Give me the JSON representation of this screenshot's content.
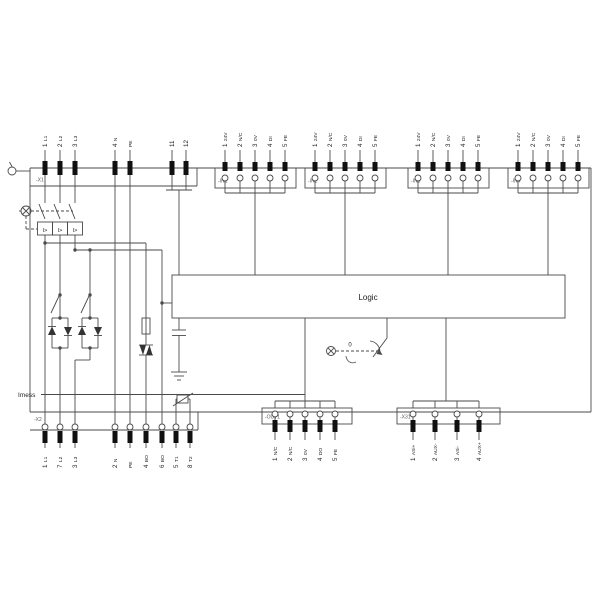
{
  "title": "wiring-schematic",
  "colors": {
    "line": "#4a4a4a",
    "text": "#1c1c1c",
    "muted": "#5a5a5a",
    "terminal": "#101010",
    "bg": "#ffffff"
  },
  "logic": {
    "label": "Logic"
  },
  "imess": {
    "label": "Imess"
  },
  "breaker": {
    "trip_label": "I>"
  },
  "manual_switch": {
    "zero_label": "0"
  },
  "top_connector": {
    "name": "-X1",
    "pins": [
      {
        "n": "1",
        "t": "L1"
      },
      {
        "n": "2",
        "t": "L2"
      },
      {
        "n": "3",
        "t": "L3"
      },
      {
        "n": "4",
        "t": "N"
      },
      {
        "n": "",
        "t": "PE"
      },
      {
        "n": "11",
        "t": ""
      },
      {
        "n": "12",
        "t": ""
      }
    ]
  },
  "input_connectors": [
    {
      "name": "-IN1",
      "pins": [
        {
          "n": "1",
          "t": "24V"
        },
        {
          "n": "2",
          "t": "N/C"
        },
        {
          "n": "3",
          "t": "0V"
        },
        {
          "n": "4",
          "t": "DI"
        },
        {
          "n": "5",
          "t": "FE"
        }
      ]
    },
    {
      "name": "-IN2",
      "pins": [
        {
          "n": "1",
          "t": "24V"
        },
        {
          "n": "2",
          "t": "N/C"
        },
        {
          "n": "3",
          "t": "0V"
        },
        {
          "n": "4",
          "t": "DI"
        },
        {
          "n": "5",
          "t": "FE"
        }
      ]
    },
    {
      "name": "-IN3",
      "pins": [
        {
          "n": "1",
          "t": "24V"
        },
        {
          "n": "2",
          "t": "N/C"
        },
        {
          "n": "3",
          "t": "0V"
        },
        {
          "n": "4",
          "t": "DI"
        },
        {
          "n": "5",
          "t": "FE"
        }
      ]
    },
    {
      "name": "-IN4",
      "pins": [
        {
          "n": "1",
          "t": "24V"
        },
        {
          "n": "2",
          "t": "N/C"
        },
        {
          "n": "3",
          "t": "0V"
        },
        {
          "n": "4",
          "t": "DI"
        },
        {
          "n": "5",
          "t": "FE"
        }
      ]
    }
  ],
  "output_connector": {
    "name": "-OUT1",
    "pins": [
      {
        "n": "1",
        "t": "N/C"
      },
      {
        "n": "2",
        "t": "N/C"
      },
      {
        "n": "3",
        "t": "0V"
      },
      {
        "n": "4",
        "t": "DO"
      },
      {
        "n": "5",
        "t": "FE"
      }
    ]
  },
  "bus_connector": {
    "name": "-X31",
    "pins": [
      {
        "n": "1",
        "t": "ASi+"
      },
      {
        "n": "2",
        "t": "AUX-"
      },
      {
        "n": "3",
        "t": "ASi-"
      },
      {
        "n": "4",
        "t": "AUX+"
      }
    ]
  },
  "bottom_connector": {
    "name": "-X2",
    "pins": [
      {
        "n": "1",
        "t": "L1"
      },
      {
        "n": "7",
        "t": "L2"
      },
      {
        "n": "3",
        "t": "L3"
      },
      {
        "n": "2",
        "t": "N"
      },
      {
        "n": "",
        "t": "PE"
      },
      {
        "n": "4",
        "t": "BO"
      },
      {
        "n": "6",
        "t": "BO"
      },
      {
        "n": "5",
        "t": "T1"
      },
      {
        "n": "8",
        "t": "T2"
      }
    ]
  }
}
